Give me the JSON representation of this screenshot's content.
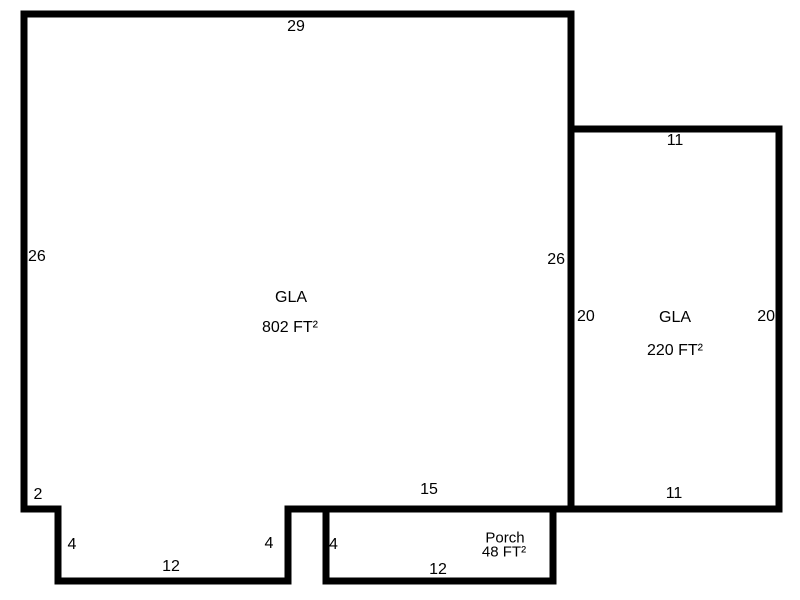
{
  "diagram": {
    "type": "floorplan-sketch",
    "background_color": "#ffffff",
    "wall_color": "#000000",
    "text_color": "#000000",
    "shapes": {
      "main_outline_points": "24,14 571,14 571,509 288,509 288,581 58,581 58,509 24,509",
      "right_wing_points": "571,129 779,129 779,509 571,509",
      "porch_points": "326,509 553,509 553,581 326,581"
    },
    "main_area": {
      "name": "GLA",
      "area": "802 FT²",
      "dims": {
        "top": "29",
        "left": "26",
        "right": "26",
        "bottom": "15",
        "step": "2",
        "notch_left": "4",
        "notch_bottom": "12",
        "notch_right": "4"
      }
    },
    "right_area": {
      "name": "GLA",
      "area": "220 FT²",
      "dims": {
        "top": "11",
        "left": "20",
        "right": "20",
        "bottom": "11"
      }
    },
    "porch_area": {
      "name": "Porch",
      "area": "48 FT²",
      "dims": {
        "left": "4",
        "bottom": "12"
      }
    }
  }
}
